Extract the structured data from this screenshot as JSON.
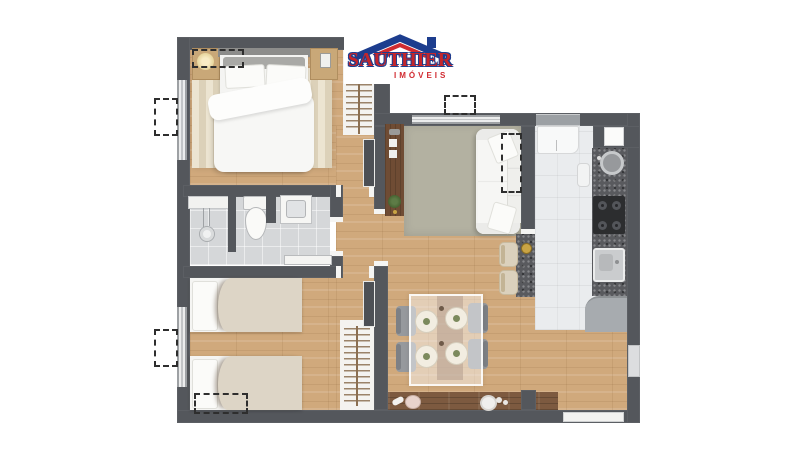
{
  "brand": {
    "name": "SAUTHIER",
    "tagline": "IMÓVEIS"
  },
  "colors": {
    "wall": "#54575c",
    "wood_floor": "#d0a97c",
    "balcony_wood": "#7d5a40",
    "bath_tile": "#d5d7d9",
    "kitchen_tile": "#eaecee",
    "living_rug": "#b3b1a1",
    "bedroom_rug": "#e7ddc6",
    "granite_counter": "#595a5e",
    "logo_red": "#c4262c",
    "logo_blue": "#1d3d8e"
  },
  "plan": {
    "type": "residential apartment floor plan, top-down 3D render",
    "rooms": [
      "master bedroom",
      "bathroom",
      "second bedroom",
      "hallway",
      "living room",
      "kitchen",
      "dining area",
      "balcony shelf"
    ],
    "furniture": [
      "double bed with nightstands and lamp",
      "open wardrobe with hangers x2",
      "shower",
      "toilet",
      "vanity sink",
      "twin beds x2",
      "sofa with throw pillows",
      "tv panel with plant",
      "glass dining table with 4 chairs and 4 place settings",
      "refrigerator",
      "round sink",
      "4-burner cooktop",
      "square sink",
      "breakfast bar with 2 stools",
      "lower cabinet",
      "dashed AC-unit markers x6"
    ]
  }
}
